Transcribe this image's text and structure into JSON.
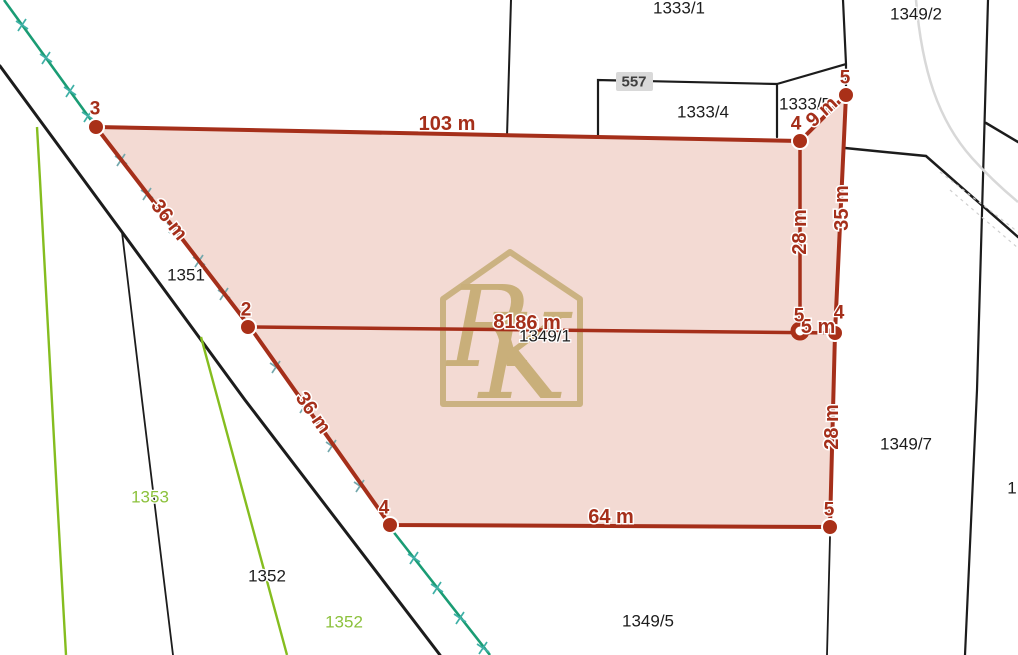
{
  "map": {
    "parcels": [
      "1333/1",
      "1349/2",
      "557",
      "1333/4",
      "1333/5",
      "1351",
      "1349/1",
      "1349/7",
      "1352",
      "1349/5",
      "1353",
      "1352",
      "1"
    ],
    "measurements": [
      "103 m",
      "9 m",
      "35 m",
      "28 m",
      "81 m",
      "86 m",
      "5 m",
      "28 m",
      "64 m",
      "36 m",
      "36 m"
    ],
    "vertices": [
      "3",
      "4",
      "5",
      "4",
      "5",
      "5",
      "4",
      "2"
    ],
    "watermark": {
      "initial_top": "R",
      "initial_bottom": "K"
    },
    "highlighted_parcel_number": "1349/1",
    "colors": {
      "boundary_red": "#a52f1a",
      "parcel_fill_pink": "#f3dad3",
      "survey_line_teal": "#1a9c74",
      "land_use_green": "#85bd1f",
      "watermark_tan": "#c2a96e",
      "cadastre_black": "#1c1c1c"
    }
  }
}
